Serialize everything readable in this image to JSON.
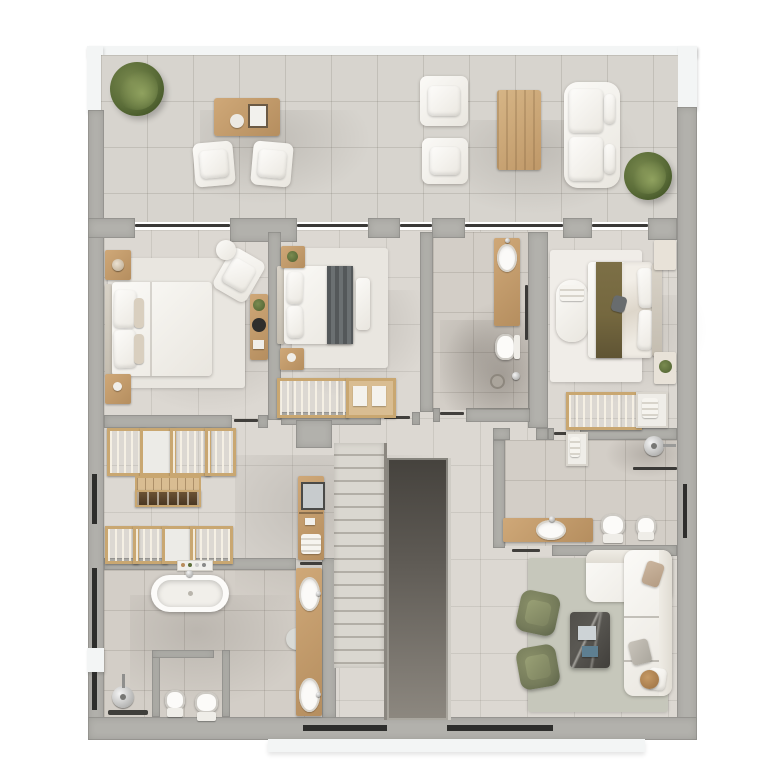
{
  "scene": {
    "type": "floor-plan-3d-render",
    "view": "top-down",
    "visible_text": [],
    "rooms": [
      {
        "name": "terrace",
        "furniture": [
          "plant",
          "dining-table",
          "armchair",
          "armchair",
          "armchair",
          "armchair",
          "coffee-table",
          "sofa",
          "plant"
        ]
      },
      {
        "name": "bedroom-left",
        "furniture": [
          "double-bed",
          "nightstand",
          "nightstand",
          "armchair",
          "side-table",
          "ladder-shelf",
          "rug"
        ]
      },
      {
        "name": "bedroom-middle",
        "furniture": [
          "double-bed",
          "nightstand",
          "nightstand",
          "bench",
          "wardrobe",
          "rug"
        ]
      },
      {
        "name": "ensuite-bathroom",
        "furniture": [
          "vanity-sink",
          "toilet",
          "shower"
        ]
      },
      {
        "name": "bedroom-right",
        "furniture": [
          "double-bed",
          "chaise",
          "nightstand",
          "nightstand",
          "wardrobe",
          "rug"
        ]
      },
      {
        "name": "walk-in-closet",
        "furniture": [
          "wardrobe-row",
          "island-dresser",
          "wardrobe-row"
        ]
      },
      {
        "name": "staircase",
        "furniture": [
          "stairs",
          "stairwell-void"
        ]
      },
      {
        "name": "bathroom-right",
        "furniture": [
          "shower",
          "vanity-sink",
          "toilet",
          "bidet",
          "towel-shelf"
        ]
      },
      {
        "name": "bathroom-main",
        "furniture": [
          "bathtub",
          "shower",
          "double-vanity",
          "toilet",
          "bidet",
          "laundry-niche"
        ]
      },
      {
        "name": "living-room",
        "furniture": [
          "corner-sofa",
          "armchair",
          "armchair",
          "coffee-table",
          "side-table",
          "rug"
        ]
      }
    ]
  },
  "palette": {
    "page_bg": "#ffffff",
    "parapet": "#f3f5f5",
    "wall": "#b2b1ac",
    "floor": "#dcd8d2",
    "floor_terrace": "#d7d4ce",
    "floor_bath": "#d3cec7",
    "floor_bath_dark": "#c8c2ba",
    "wood": "#cfa878",
    "wood_frame": "#c9a771",
    "cabinet_dark": "#5d4530",
    "white_furniture": "#f7f5f1",
    "rug": "#e9e6e0",
    "rug_living": "#c6c7bb",
    "olive_chair": "#767c5b",
    "plant_green": "#5c6e3b",
    "runner_gray": "#5a5e60",
    "runner_olive": "#75683f",
    "marble": "#4d4b47",
    "glass_dark": "#3a3937",
    "window_dark": "#2e2e2c",
    "stair_void": "#55514b",
    "sink_white": "#fbfaf8"
  }
}
